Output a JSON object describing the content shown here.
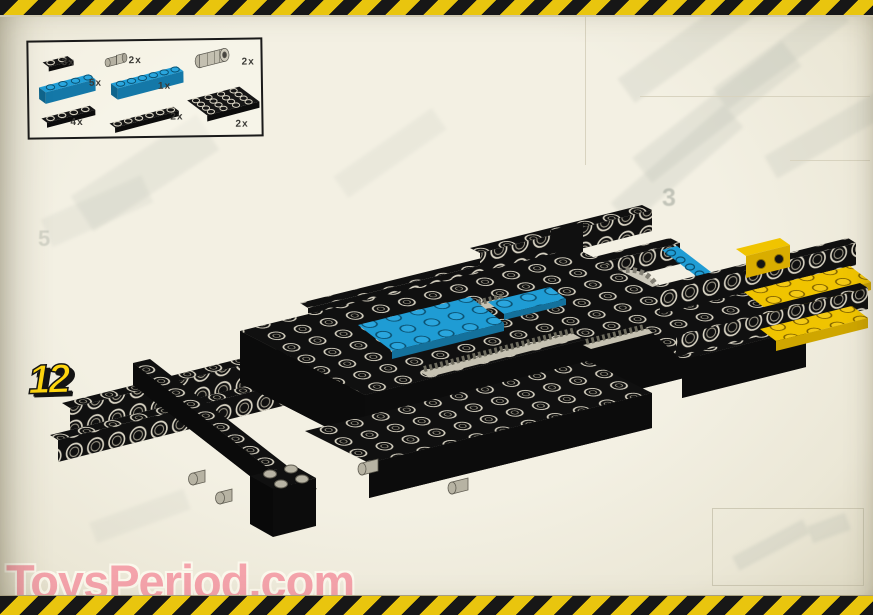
{
  "page": {
    "step_number": "12",
    "watermark_text": "ToysPeriod.com",
    "ghost_step_number_left": "5",
    "ghost_step_number_right": "3"
  },
  "parts_box": {
    "items": [
      {
        "part": "black-plate-1x2",
        "qty": "3x"
      },
      {
        "part": "gray-connector-peg",
        "qty": "2x"
      },
      {
        "part": "gray-driving-ring",
        "qty": "2x"
      },
      {
        "part": "blue-brick-1x4",
        "qty": "5x"
      },
      {
        "part": "blue-brick-1x6",
        "qty": "1x"
      },
      {
        "part": "black-plate-1x4",
        "qty": "4x"
      },
      {
        "part": "black-plate-1x6",
        "qty": "2x"
      },
      {
        "part": "black-plate-4x4",
        "qty": "2x"
      }
    ]
  },
  "colors": {
    "hazard_yellow": "#e9c50e",
    "hazard_black": "#171717",
    "page_background": "#f0edde",
    "brick_black": "#101010",
    "brick_blue": "#1f9cd4",
    "brick_yellow": "#f0c400",
    "brick_gray": "#c2beae",
    "step_number_yellow": "#ffd60f",
    "watermark_pink": "#f4a3ab"
  }
}
